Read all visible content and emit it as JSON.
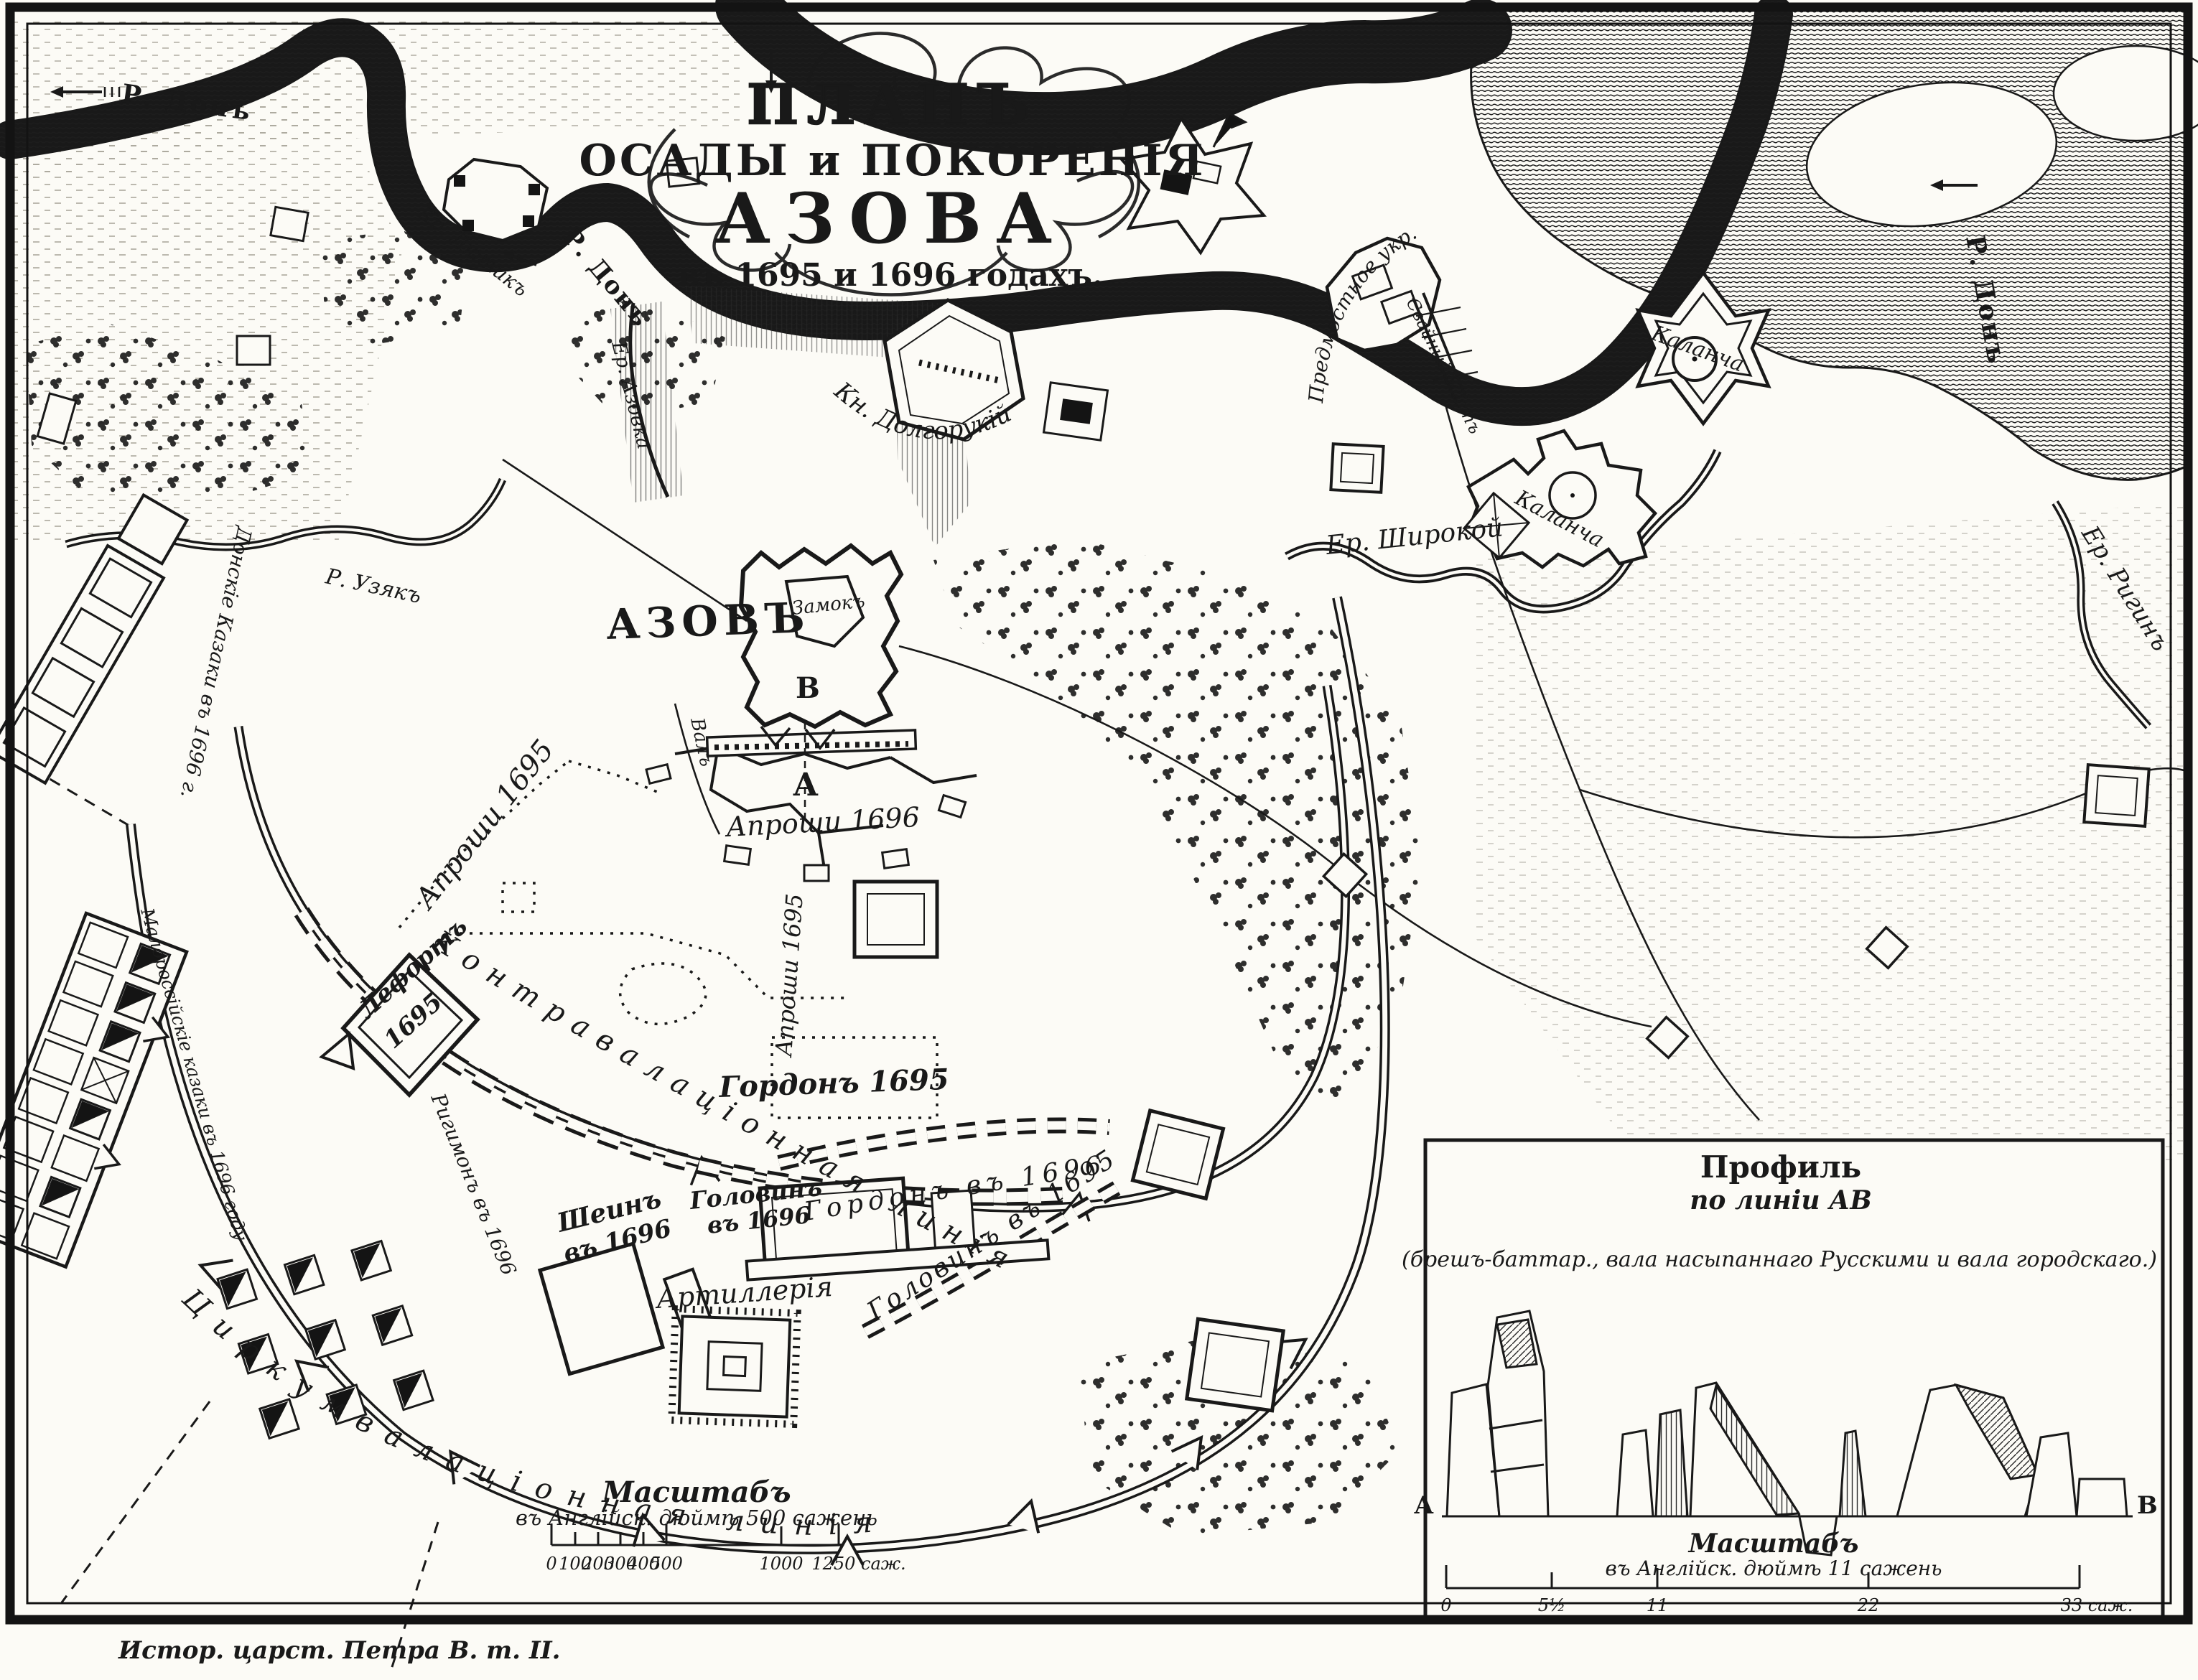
{
  "title": {
    "l1": "ПЛАНЪ",
    "l2": "ОСАДЫ и ПОКОРЕНІЯ",
    "l3": "АЗОВА",
    "l4": "въ 1695 и 1696 годахъ."
  },
  "caption": "Истор. царст. Петра В. т. II.",
  "city": {
    "name": "АЗОВЪ",
    "castle": "Замокъ",
    "point_a": "А",
    "point_b": "В",
    "rampart": "Валъ"
  },
  "rivers": {
    "don_nw": "Р. Донъ",
    "don_mid": "Р. Донъ",
    "don_e": "Р. Донъ",
    "uzyak": "Р. Узякъ",
    "shirokoy": "Ер. Широкой",
    "rigin": "Ер. Ригинъ",
    "azovka": "Ер. Азовка"
  },
  "forts": {
    "kalancha_ne": "Каланча",
    "kalancha_e": "Каланча",
    "dolgoruky": "Кн. Долгорукій",
    "lyutik": "Кр. Лютикъ",
    "bridgehead": "Предмостное укр.",
    "bridge": "Свайный мостъ",
    "lefort_l1": "Лефортъ",
    "lefort_l2": "1695",
    "gordon_redoubt": "Гордонъ 1695"
  },
  "camps": {
    "shein_l1": "Шеинъ",
    "shein_l2": "въ 1696",
    "golovin96_l1": "Головинъ",
    "golovin96_l2": "въ 1696",
    "gordon96": "Гордонъ въ 1696",
    "golovin95": "Головинъ въ 1695",
    "rigimon": "Ригимонъ въ 1696",
    "artillery": "Артиллерія",
    "malorossy": "Малороссійскіе казаки въ 1696 году",
    "donskie": "Донскіе Казаки въ 1696 г."
  },
  "siege": {
    "contravallation": "Контравалаціонная линія",
    "circumvallation": "Циркумвалаціонная линія",
    "aproshi_1695_nw": "Апроши 1695",
    "aproshi_1695_c": "Апроши 1695",
    "aproshi_1696": "Апроши 1696"
  },
  "main_scale": {
    "title": "Масштабъ",
    "subtitle": "въ Англійск. дюймѣ 500 сажень",
    "unit_ticks": [
      "0",
      "100",
      "200",
      "300",
      "400",
      "500",
      "1000",
      "1250 саж."
    ]
  },
  "inset": {
    "title": "Профиль",
    "subtitle": "по линіи АВ",
    "note": "(брешъ-баттар., вала насыпаннаго Русскими и вала городскаго.)",
    "point_a": "A",
    "point_b": "B",
    "scale_title": "Масштабъ",
    "scale_subtitle": "въ Англійск. дюймѣ 11 сажень",
    "unit_ticks": [
      "0",
      "5½",
      "11",
      "22",
      "33 саж."
    ]
  }
}
